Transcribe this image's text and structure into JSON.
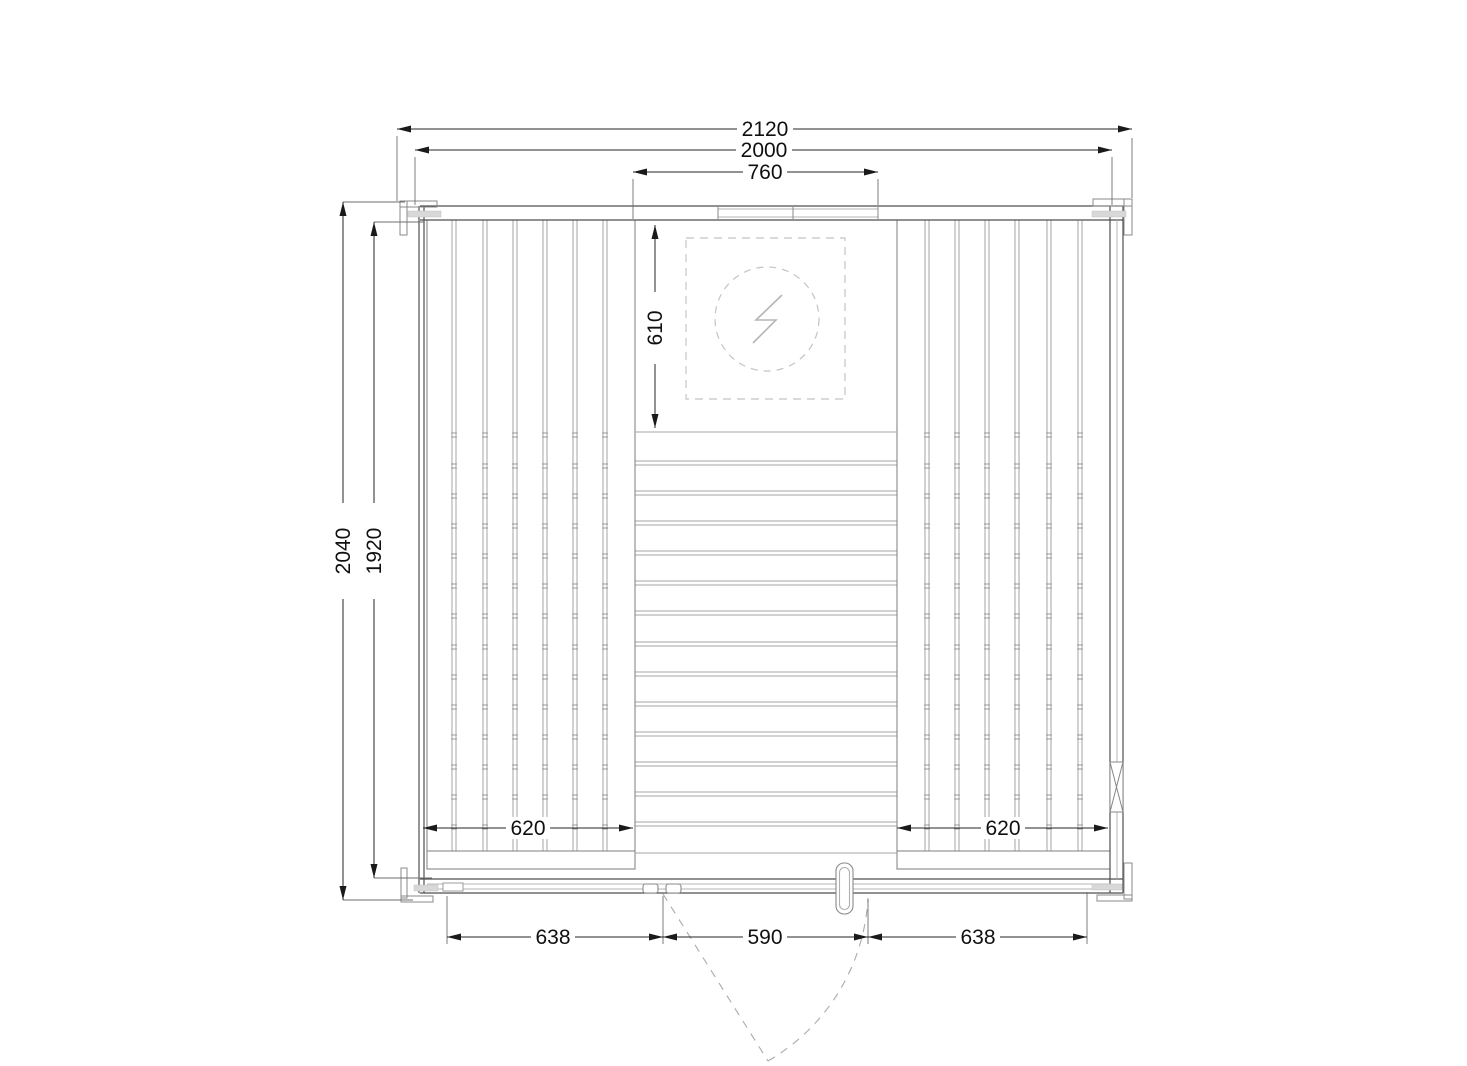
{
  "document": {
    "type": "technical-drawing",
    "view": "floor-plan-top-view",
    "subject": "sauna cabin with benches, electric heater and hinged door"
  },
  "dims": {
    "overall_width": {
      "value": "2120"
    },
    "frame_width": {
      "value": "2000"
    },
    "heater_bay_width": {
      "value": "760"
    },
    "overall_depth": {
      "value": "2040"
    },
    "inner_depth": {
      "value": "1920"
    },
    "heater_zone_depth": {
      "value": "610"
    },
    "left_bench_width": {
      "value": "620"
    },
    "right_bench_width": {
      "value": "620"
    },
    "front_left_panel": {
      "value": "638"
    },
    "door_opening_width": {
      "value": "590"
    },
    "front_right_panel": {
      "value": "638"
    }
  },
  "symbols": {
    "heater": "lightning-bolt-in-dashed-circle",
    "wall_vent": "bowtie-marker",
    "door_swing": "dashed-arc"
  },
  "drawing": {
    "bench_top": 220,
    "bench_bottom": 851,
    "left_bench_gaps": [
      454,
      485,
      515,
      545,
      575,
      605
    ],
    "right_bench_gaps": [
      927,
      957,
      987,
      1017,
      1049,
      1080
    ],
    "floor_left": 635,
    "floor_right": 897,
    "floor_top": 432,
    "floor_bottom": 853,
    "floor_joints": [
      463,
      493,
      523,
      553,
      583,
      613,
      644,
      674,
      704,
      734,
      764,
      794,
      824
    ],
    "tick_rows": [
      433,
      464,
      494,
      524,
      554,
      584,
      614,
      645,
      675,
      705,
      735,
      765,
      795,
      825
    ]
  }
}
